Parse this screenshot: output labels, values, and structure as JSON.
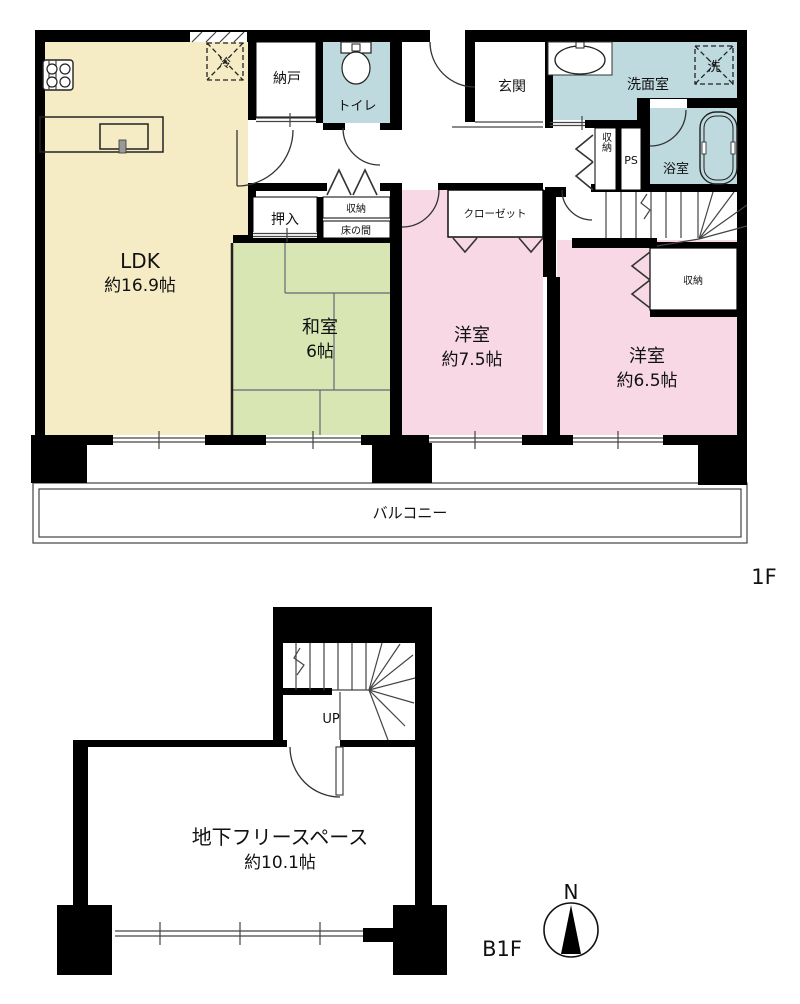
{
  "plan": {
    "floor1": {
      "floor_label": "1F",
      "ldk_name": "LDK",
      "ldk_size": "約16.9帖",
      "washitsu_name": "和室",
      "washitsu_size": "6帖",
      "western1_name": "洋室",
      "western1_size": "約7.5帖",
      "western2_name": "洋室",
      "western2_size": "約6.5帖",
      "nando": "納戸",
      "toilet": "トイレ",
      "entrance": "玄関",
      "washroom": "洗面室",
      "bathroom": "浴室",
      "oshiire": "押入",
      "hall_storage": "収納",
      "tokonoma": "床の間",
      "closet": "クローゼット",
      "side_storage": "収納",
      "pipe_space": "PS",
      "west2_storage": "収納",
      "balcony": "バルコニー",
      "fridge_mark": "冷",
      "washer_mark": "洗"
    },
    "b1f": {
      "floor_label": "B1F",
      "room_name": "地下フリースペース",
      "room_size": "約10.1帖",
      "stairs_up": "UP"
    },
    "compass_north": "N",
    "colors": {
      "ldk": "#f5ecc6",
      "tatami": "#d7e6b2",
      "western": "#f7d8e4",
      "wet": "#bedade",
      "wall": "#000000"
    }
  }
}
